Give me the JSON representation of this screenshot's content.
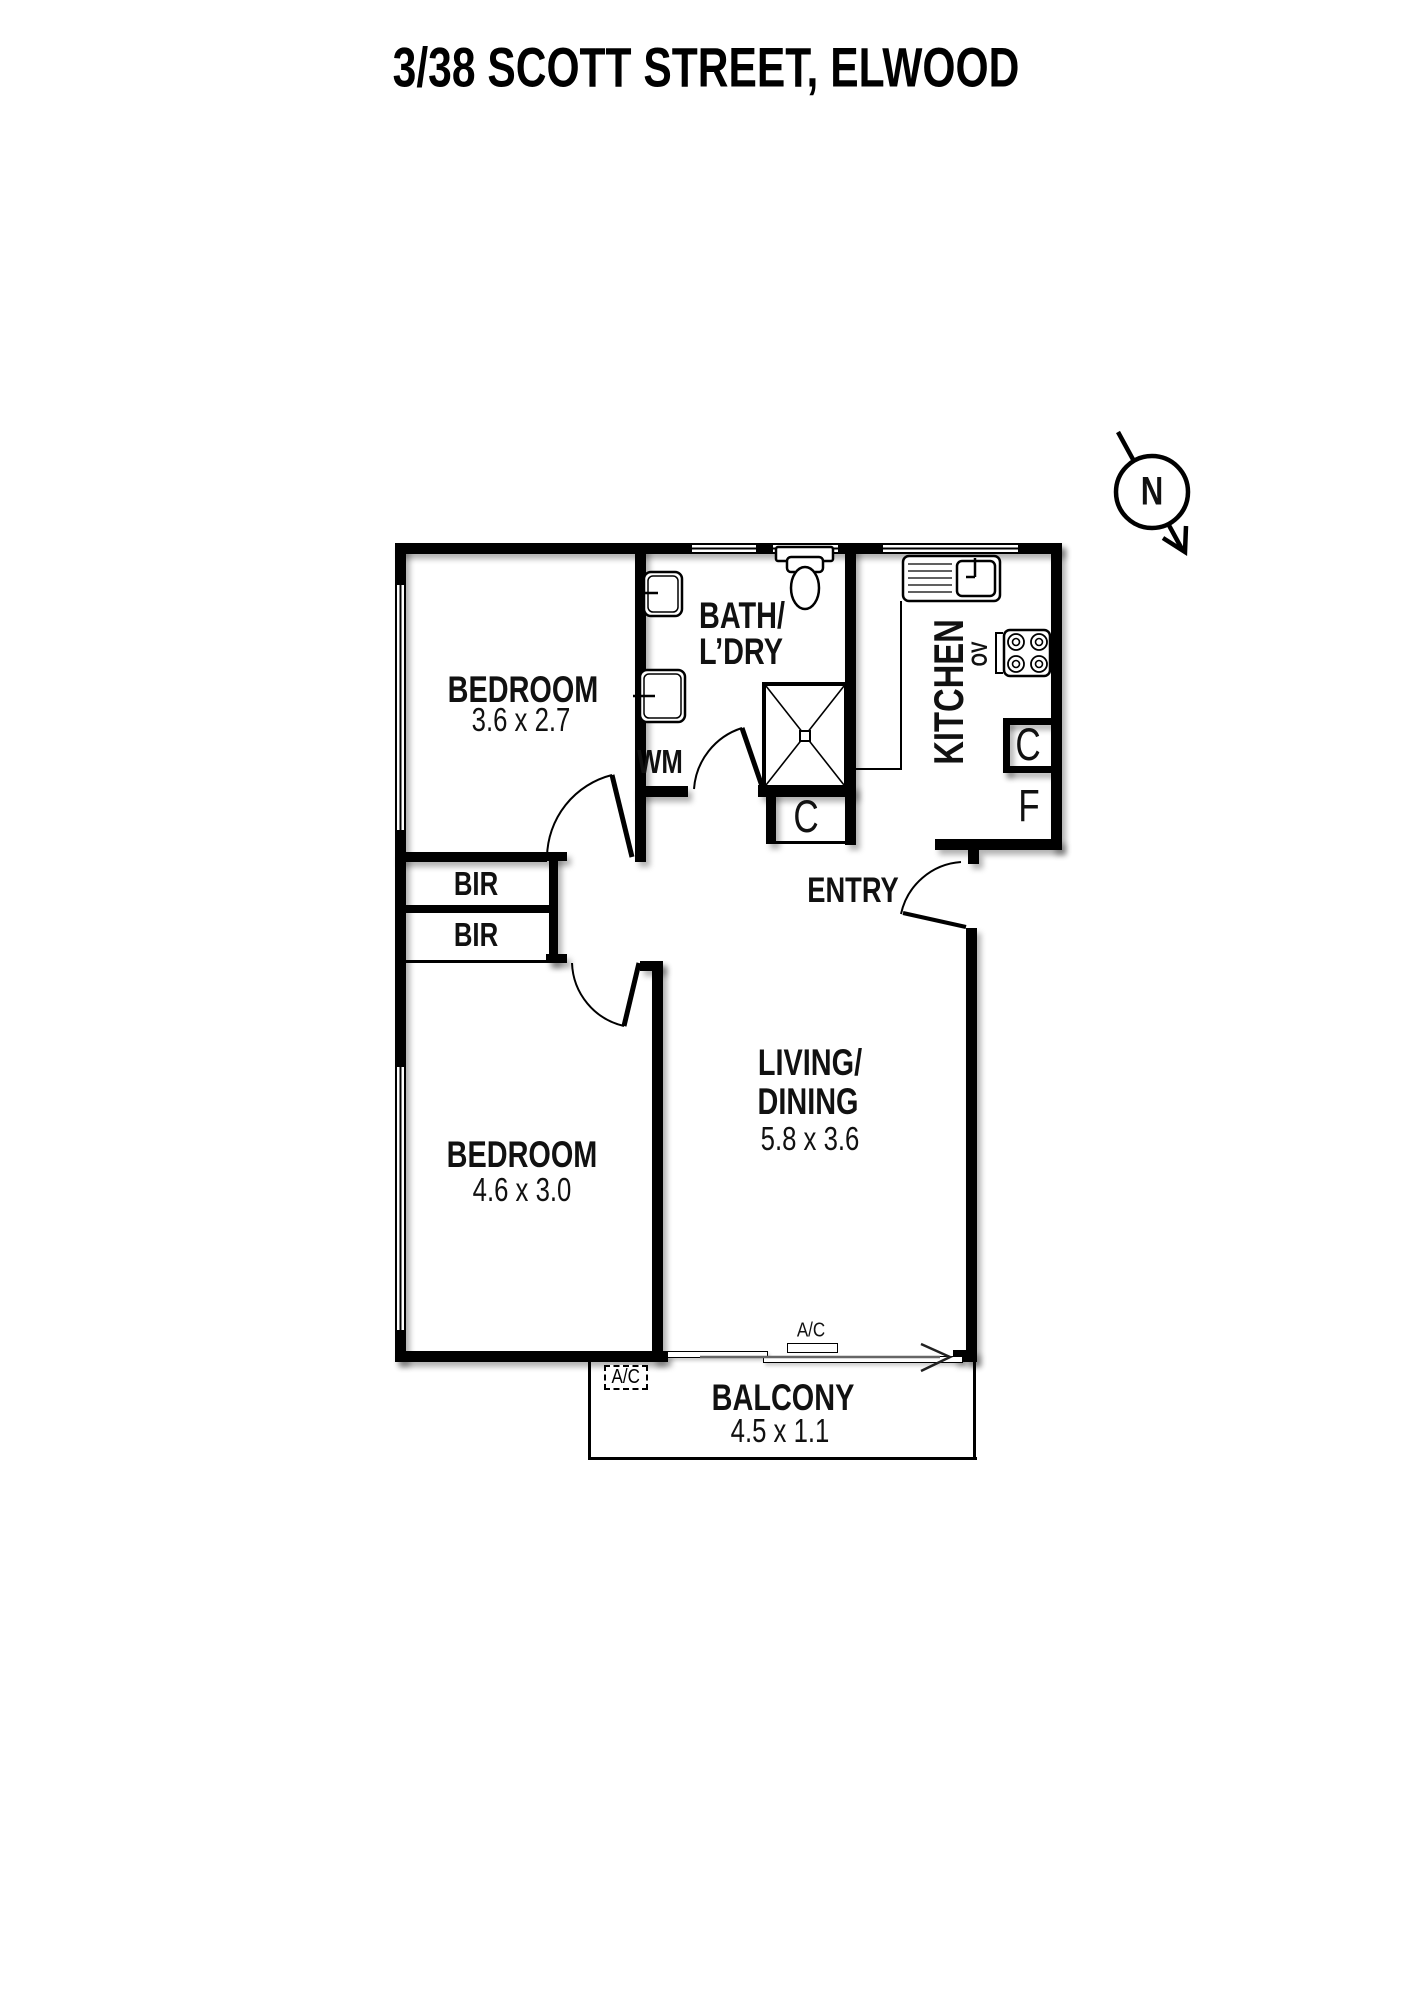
{
  "title": "3/38 SCOTT STREET, ELWOOD",
  "compass": {
    "north_label": "N"
  },
  "rooms": {
    "bedroom1": {
      "name": "BEDROOM",
      "dims": "3.6 x 2.7"
    },
    "bedroom2": {
      "name": "BEDROOM",
      "dims": "4.6 x 3.0"
    },
    "bath_laundry": {
      "line1": "BATH/",
      "line2": "L’DRY"
    },
    "kitchen": {
      "name": "KITCHEN"
    },
    "living_dining": {
      "line1": "LIVING/",
      "line2": "DINING",
      "dims": "5.8 x 3.6"
    },
    "entry": {
      "name": "ENTRY"
    },
    "balcony": {
      "name": "BALCONY",
      "dims": "4.5 x 1.1"
    }
  },
  "fixtures": {
    "bir1": "BIR",
    "bir2": "BIR",
    "washing_machine": "WM",
    "oven": "OV",
    "bath_cupboard": "C",
    "kitchen_cupboard": "C",
    "fridge": "F",
    "ac_unit_door": "A/C",
    "ac_unit_balcony": "A/C"
  }
}
